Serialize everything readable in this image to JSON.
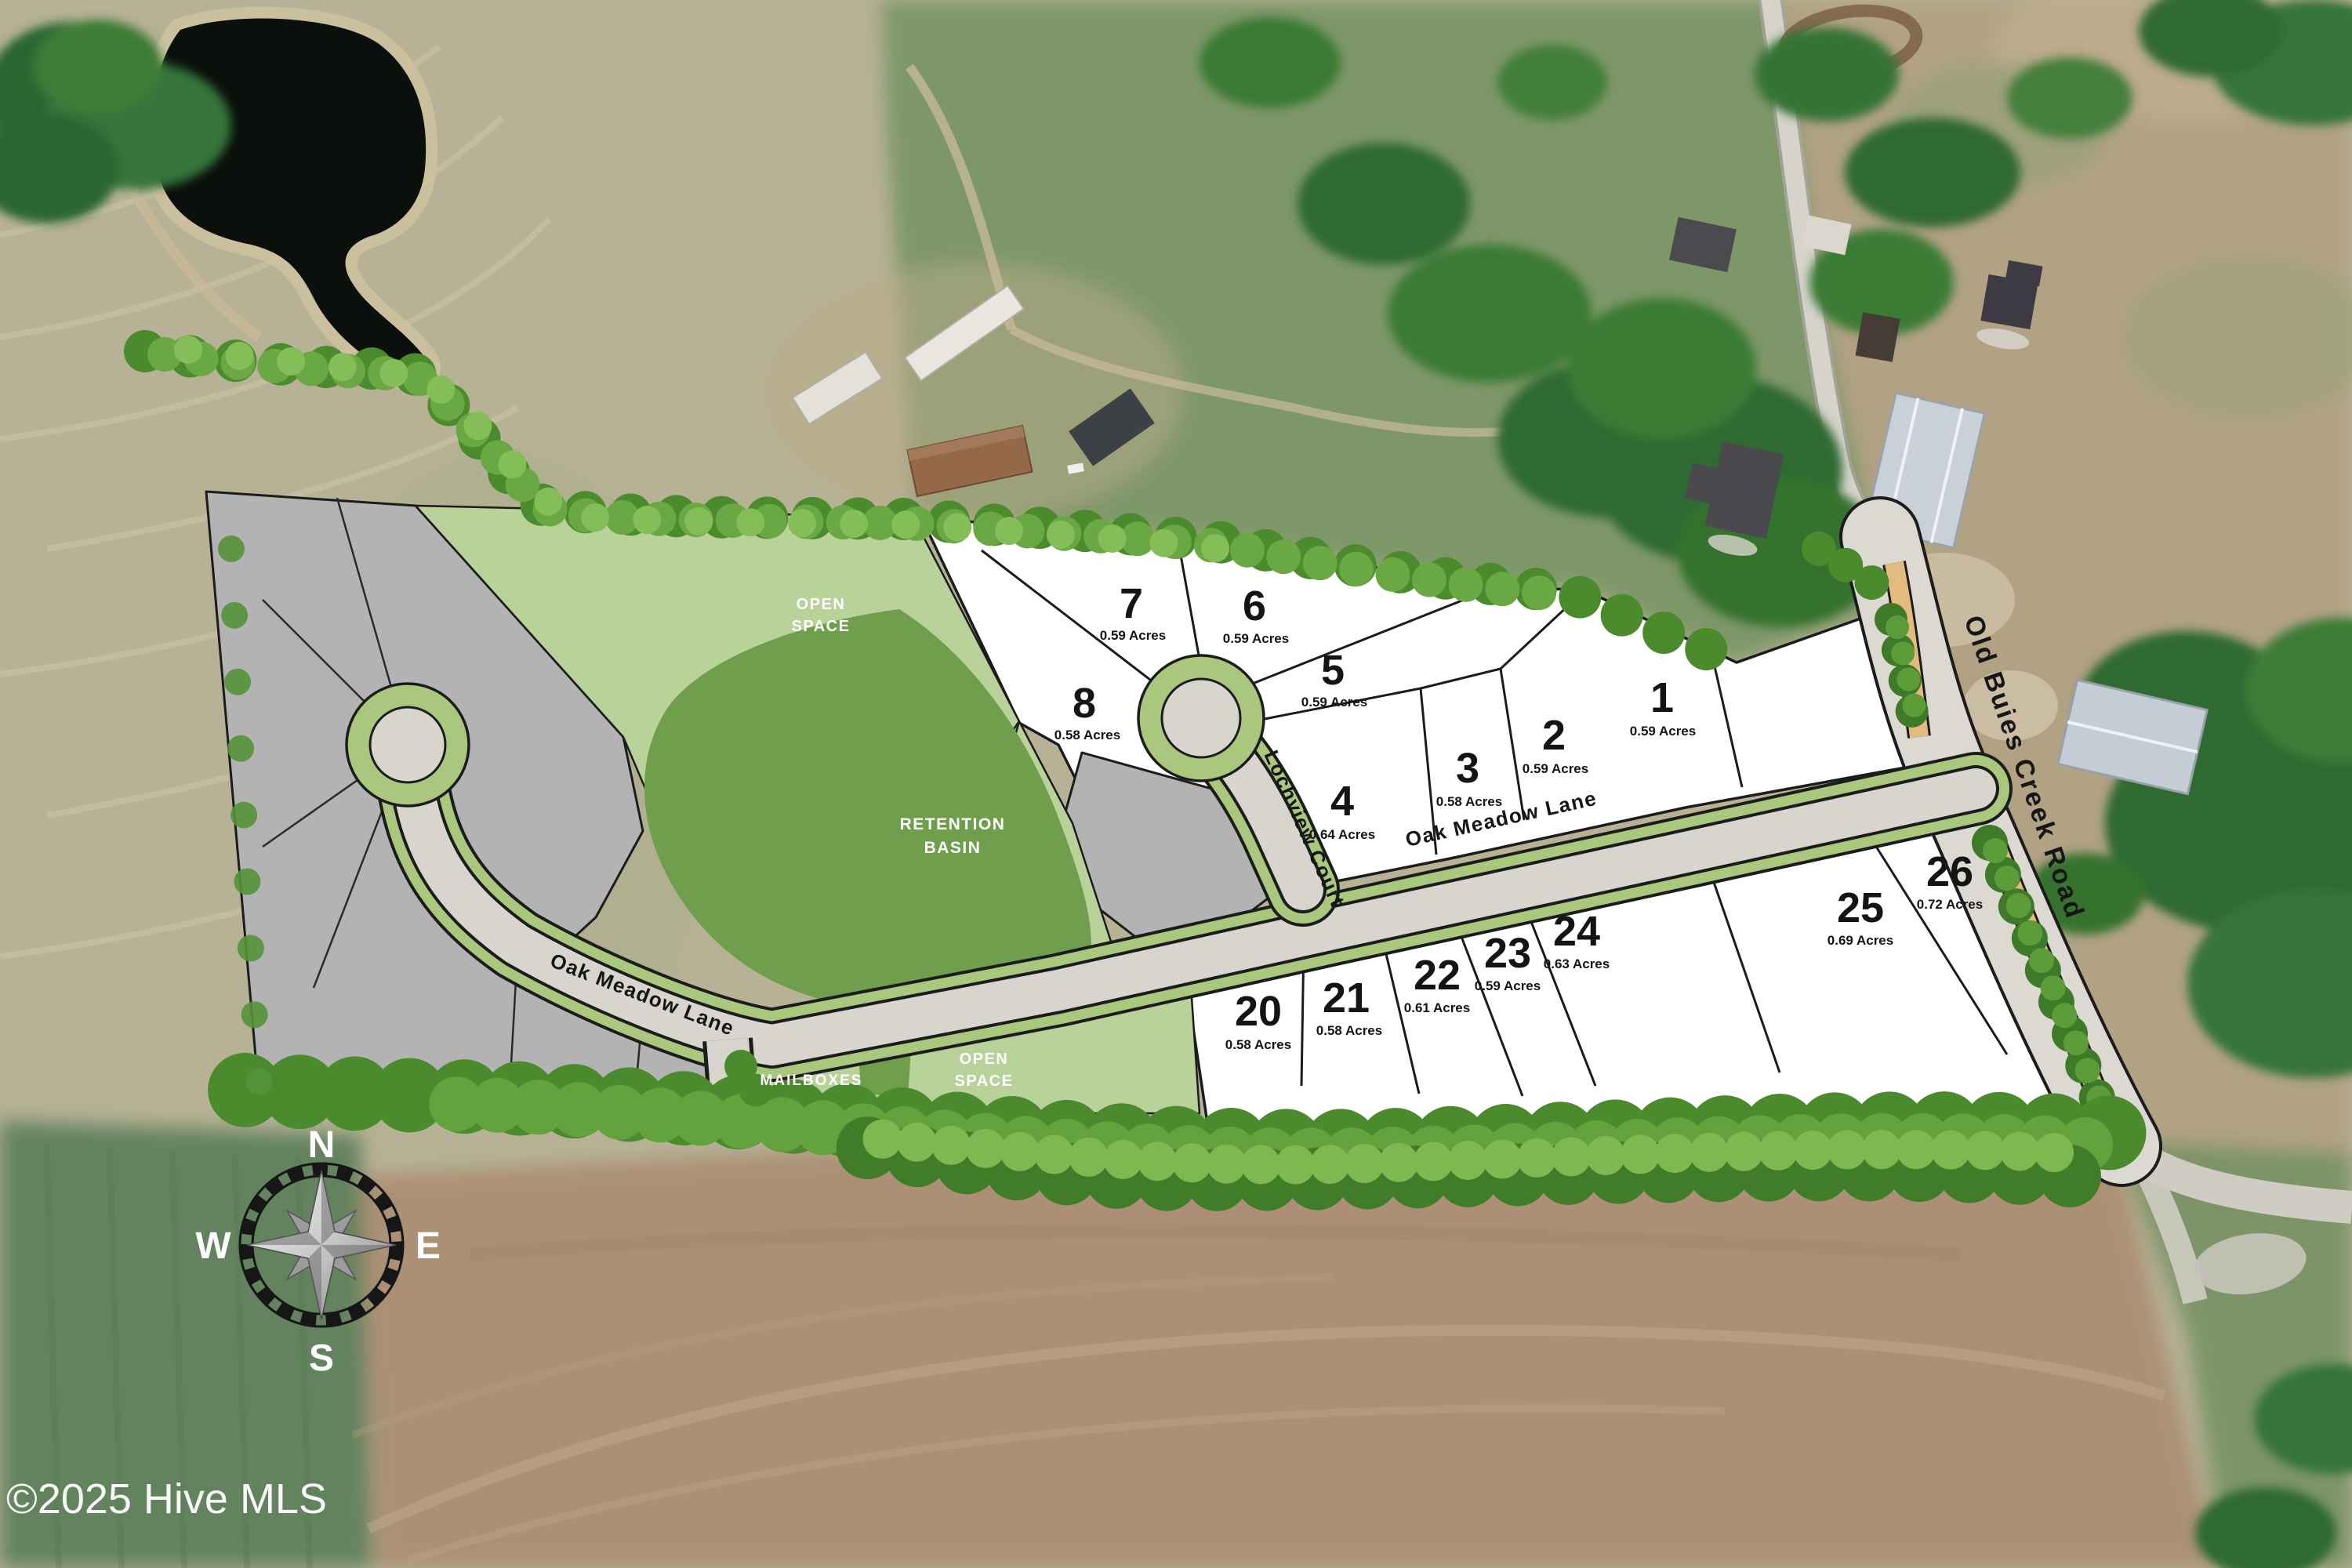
{
  "map": {
    "watermark": "©2025 Hive MLS",
    "compass": {
      "north": "N",
      "east": "E",
      "south": "S",
      "west": "W"
    },
    "streets": {
      "oak_meadow_lane": "Oak Meadow Lane",
      "lochview_court": "Lochview Court",
      "old_buies_creek_road": "Old Buies Creek Road"
    },
    "labels": {
      "open_space": [
        "OPEN",
        "SPACE"
      ],
      "retention_basin": [
        "RETENTION",
        "BASIN"
      ],
      "mailboxes": "MAILBOXES"
    },
    "lots": [
      {
        "number": "1",
        "acres": "0.59 Acres"
      },
      {
        "number": "2",
        "acres": "0.59 Acres"
      },
      {
        "number": "3",
        "acres": "0.58 Acres"
      },
      {
        "number": "4",
        "acres": "0.64 Acres"
      },
      {
        "number": "5",
        "acres": "0.59 Acres"
      },
      {
        "number": "6",
        "acres": "0.59 Acres"
      },
      {
        "number": "7",
        "acres": "0.59 Acres"
      },
      {
        "number": "8",
        "acres": "0.58 Acres"
      },
      {
        "number": "20",
        "acres": "0.58 Acres"
      },
      {
        "number": "21",
        "acres": "0.58 Acres"
      },
      {
        "number": "22",
        "acres": "0.61 Acres"
      },
      {
        "number": "23",
        "acres": "0.59 Acres"
      },
      {
        "number": "24",
        "acres": "0.63 Acres"
      },
      {
        "number": "25",
        "acres": "0.69 Acres"
      },
      {
        "number": "26",
        "acres": "0.72 Acres"
      }
    ],
    "colors": {
      "lot_fill": "#ffffff",
      "reserve_parcel_fill": "#b3b3b3",
      "open_space_green": "#b9d29a",
      "retention_basin_green": "#6f9e4c",
      "road_verge_green": "#a9c87d",
      "pavement_gray": "#d8d5ce",
      "shoulder_tan": "#e3bb80",
      "pond_dark": "#0b100d"
    }
  }
}
